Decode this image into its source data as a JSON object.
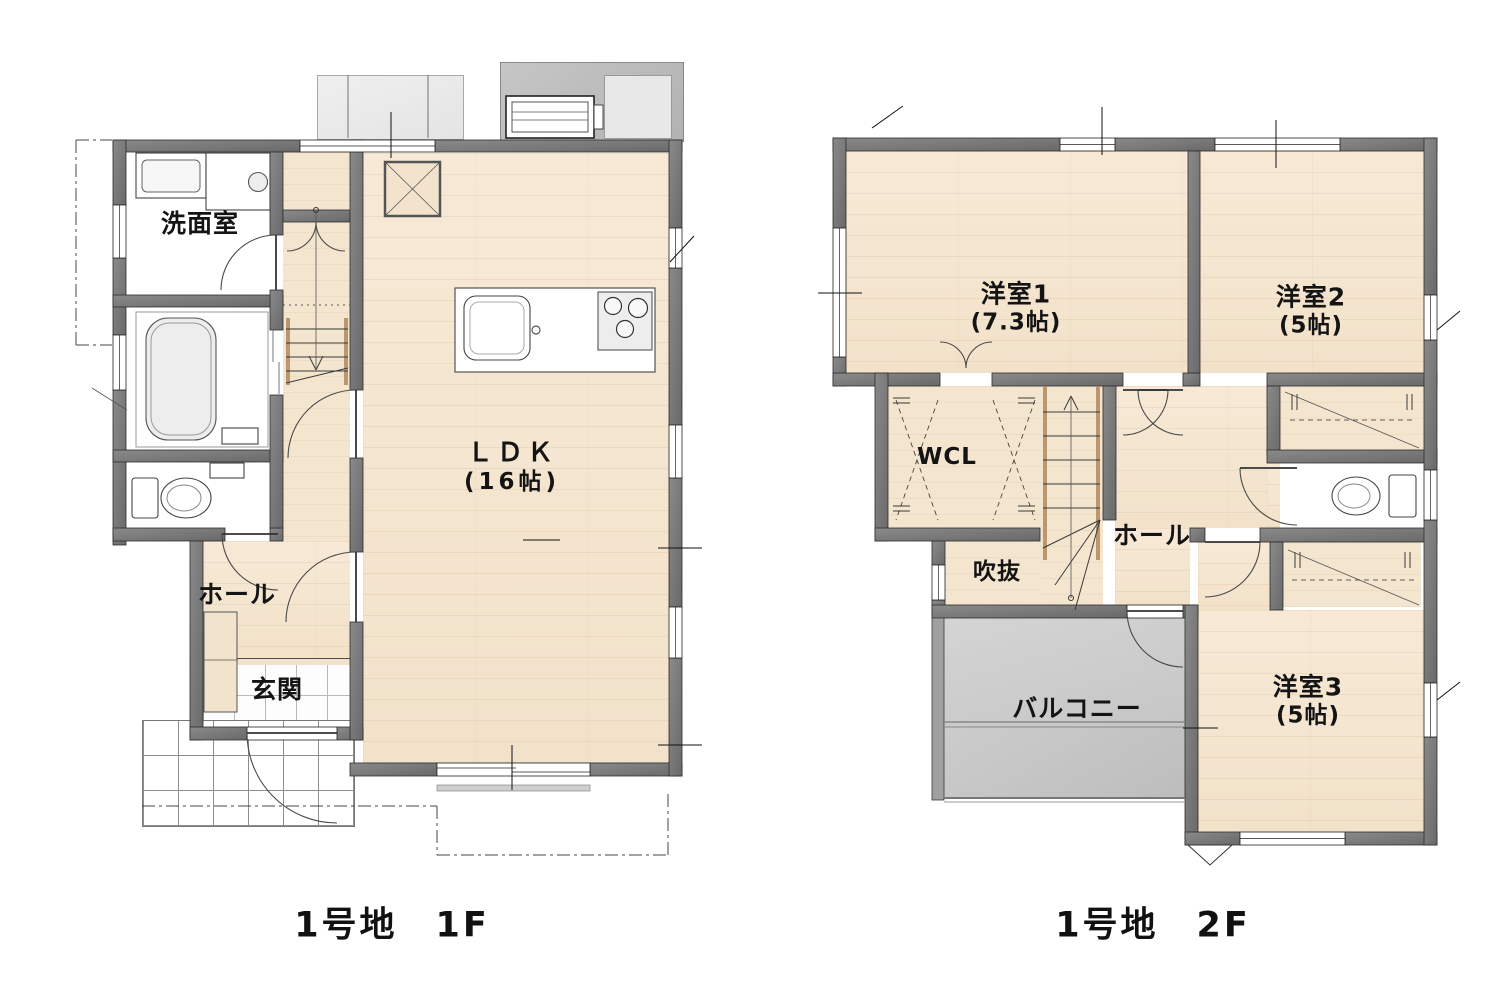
{
  "captions": {
    "floor1": "1号地　1F",
    "floor2": "1号地　2F"
  },
  "floor1": {
    "rooms": {
      "senmen": {
        "name": "洗面室"
      },
      "ldk": {
        "name": "ＬＤＫ",
        "size": "(16帖)"
      },
      "hall": {
        "name": "ホール"
      },
      "genkan": {
        "name": "玄関"
      }
    }
  },
  "floor2": {
    "rooms": {
      "yoshitsu1": {
        "name": "洋室1",
        "size": "(7.3帖)"
      },
      "yoshitsu2": {
        "name": "洋室2",
        "size": "(5帖)"
      },
      "wcl": {
        "name": "WCL"
      },
      "hall": {
        "name": "ホール"
      },
      "fukinuke": {
        "name": "吹抜"
      },
      "balcony": {
        "name": "バルコニー"
      },
      "yoshitsu3": {
        "name": "洋室3",
        "size": "(5帖)"
      }
    }
  },
  "colors": {
    "wall_gray": "#777777",
    "floor_wood": "#f6e8d3",
    "closet_beige": "#f4e5cf",
    "balcony_gray": "#cccccc",
    "tile_white": "#fdfdfd",
    "line_black": "#222222"
  }
}
